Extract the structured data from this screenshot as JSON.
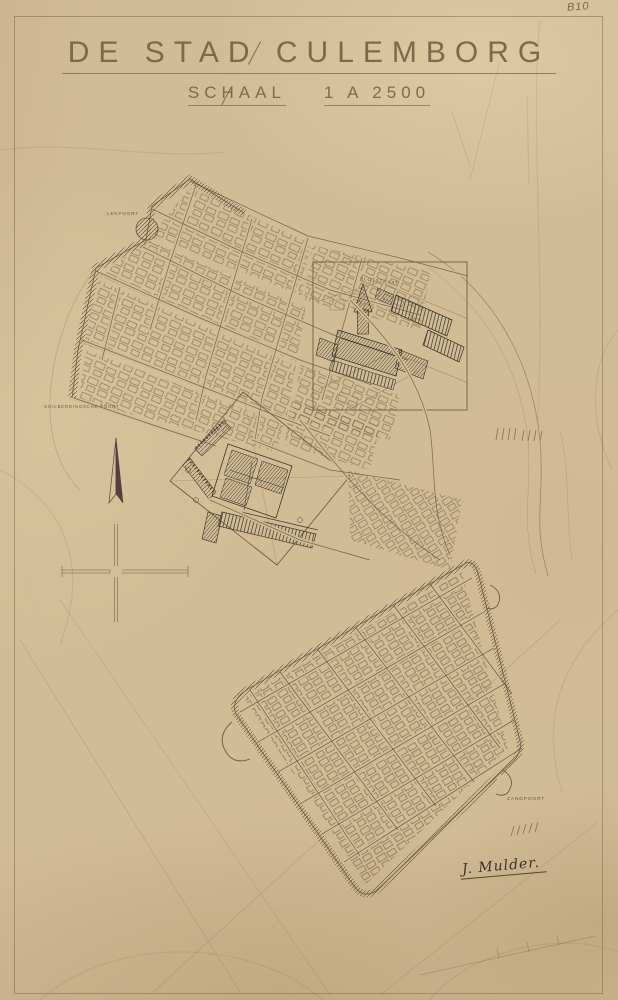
{
  "document": {
    "archive_mark": "B10",
    "title": "DE STAD CULEMBORG",
    "scale_label": "SCHAAL",
    "scale_value": "1 A 2500",
    "signature": "J. Mulder."
  },
  "map": {
    "place_labels": [
      {
        "id": "lekpoort",
        "text": "LEKPOORT"
      },
      {
        "id": "goilberdinger-poort",
        "text": "GOILBERDINGSCHE POORT"
      },
      {
        "id": "slotstraat",
        "text": "SLOTSTRAAT"
      },
      {
        "id": "zandpoort",
        "text": "ZANDPOORT."
      }
    ],
    "colors": {
      "paper": "#d2bc95",
      "pencil_line": "#77664c",
      "ink_dark": "#3a342c",
      "compass_needle": "#5a3e44"
    }
  }
}
